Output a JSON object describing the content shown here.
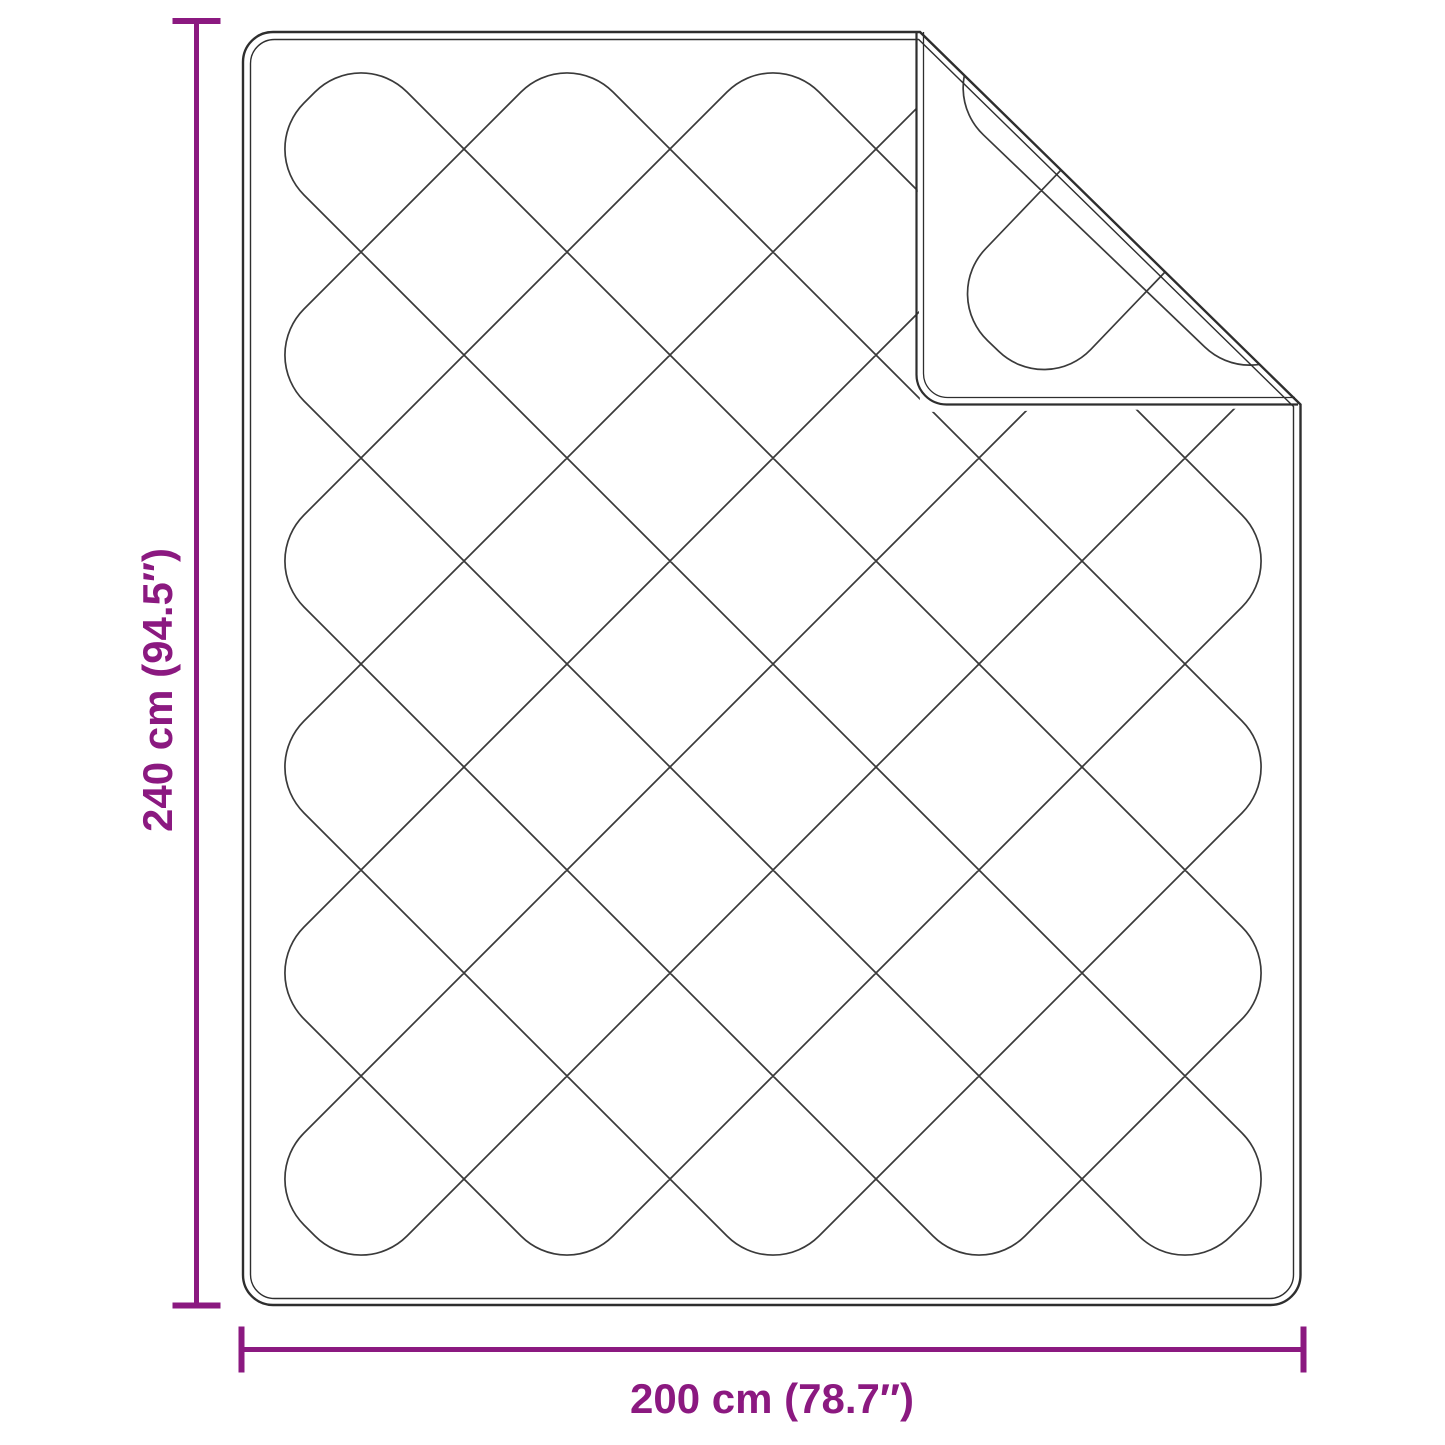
{
  "diagram": {
    "height_dimension": {
      "label": "240 cm (94.5″)"
    },
    "width_dimension": {
      "label": "200 cm (78.7″)"
    },
    "colors": {
      "dimension": "#8B1980",
      "outline": "#2E2E2E",
      "pattern": "#3A3A3A",
      "background": "#FFFFFF"
    }
  }
}
